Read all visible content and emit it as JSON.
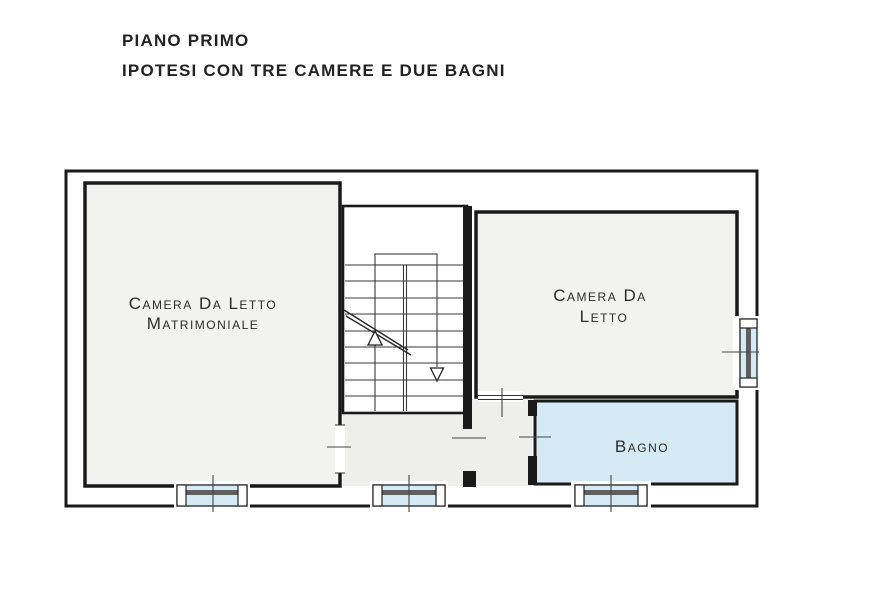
{
  "header": {
    "line1": "PIANO PRIMO",
    "line2": "IPOTESI CON TRE CAMERE E DUE BAGNI"
  },
  "rooms": {
    "master_bedroom": {
      "label_line1": "Camera Da Letto",
      "label_line2": "Matrimoniale"
    },
    "bedroom": {
      "label_line1": "Camera Da",
      "label_line2": "Letto"
    },
    "bathroom": {
      "label": "Bagno"
    }
  },
  "colors": {
    "wall": "#1a1a1a",
    "room_fill": "#f2f2f0",
    "hall_fill": "#eeeeec",
    "water_fill": "#d6eaf6",
    "line": "#3a3a3a",
    "text": "#2b2b2b"
  }
}
